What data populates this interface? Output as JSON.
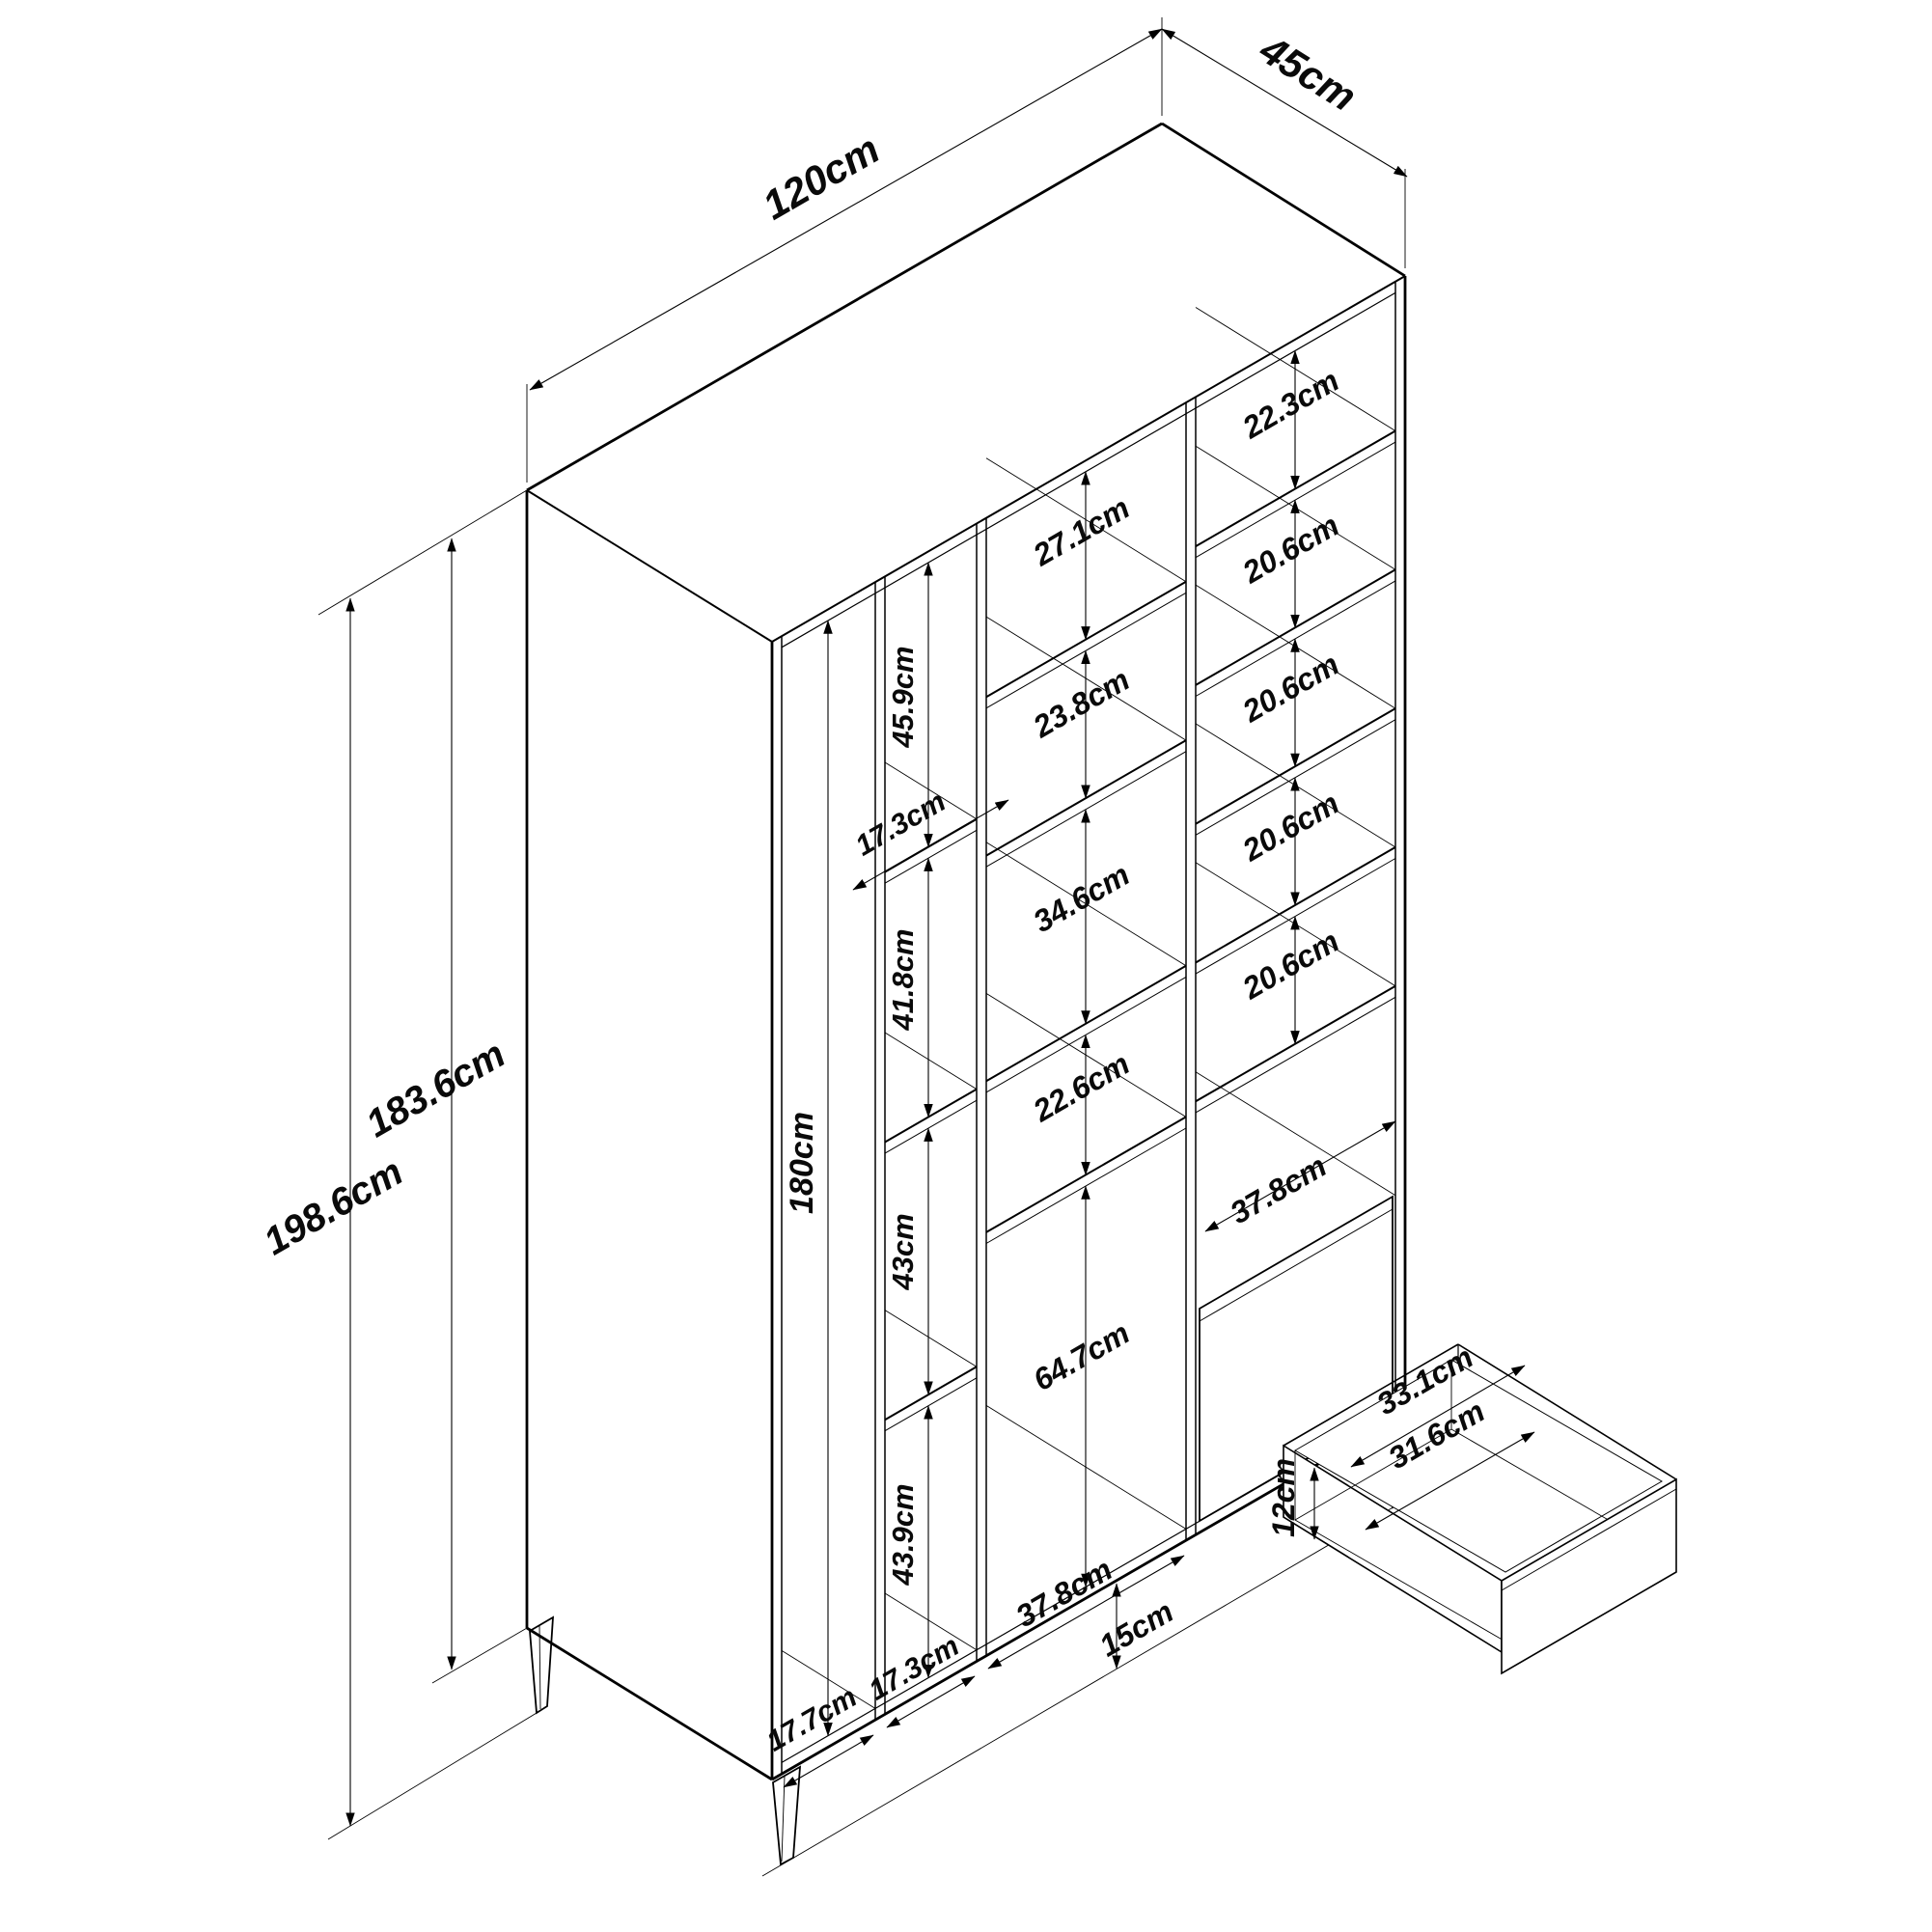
{
  "diagram": {
    "type": "furniture-dimension-drawing",
    "subject": "wardrobe with shelf columns and drawers, isometric view",
    "unit": "cm",
    "line_color": "#000000",
    "background_color": "#ffffff"
  },
  "overall": {
    "width": "120cm",
    "depth": "45cm",
    "total_height": "198.6cm",
    "body_height": "183.6cm",
    "leg_height": "15cm"
  },
  "door_section": {
    "inner_height": "180cm",
    "width": "17.7cm"
  },
  "narrow_column": {
    "width": "17.3cm",
    "bottom_width": "17.3cm",
    "sections": [
      "45.9cm",
      "41.8cm",
      "43cm",
      "43.9cm"
    ]
  },
  "middle_column": {
    "width": "37.8cm",
    "sections": [
      "27.1cm",
      "23.8cm",
      "34.6cm",
      "22.6cm",
      "64.7cm"
    ]
  },
  "right_column": {
    "drawer_opening_width": "37.8cm",
    "sections": [
      "22.3cm",
      "20.6cm",
      "20.6cm",
      "20.6cm",
      "20.6cm"
    ]
  },
  "drawer": {
    "outer_width": "33.1cm",
    "inner_width": "31.6cm",
    "inner_depth": "12cm"
  }
}
